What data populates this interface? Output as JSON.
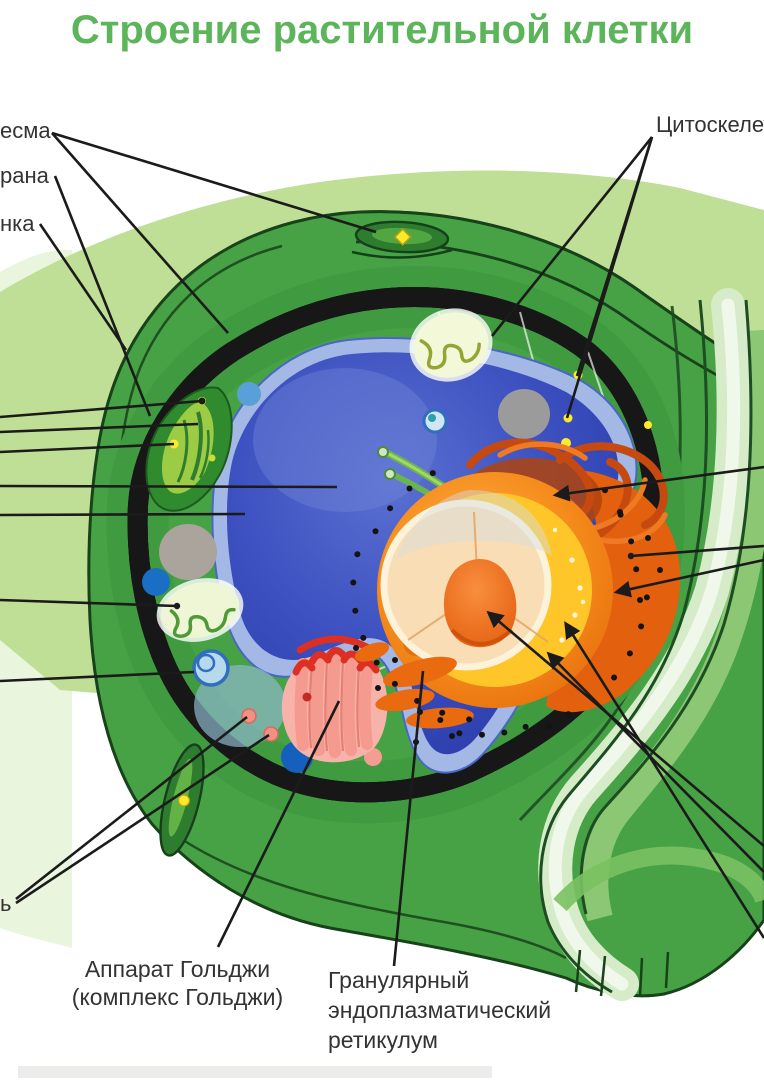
{
  "title": "Строение растительной клетки",
  "labels": {
    "plasmodesma_fragment": "есма",
    "membrane_fragment": "рана",
    "wall_fragment": "нка",
    "cytoskeleton": "Цитоскелет",
    "vacuole_fragment": "ь",
    "golgi_line1": "Аппарат Гольджи",
    "golgi_line2": "(комплекс Гольджи)",
    "er_line1": "Гранулярный",
    "er_line2": "эндоплазматический",
    "er_line3": "ретикулум"
  },
  "colors": {
    "title_green": "#5cb55a",
    "label_text": "#333333",
    "back_light_green": "#bedf95",
    "pale_left_band": "#e9f5dd",
    "wall_green": "#47a245",
    "wall_inner_green": "#3f9a40",
    "wall_dark_outline": "#17421a",
    "membrane_yellow": "#f9e426",
    "cytoplasm_blue": "#b7dbf1",
    "vacuole_blue": "#3a4fc0",
    "vacuole_halo": "#a3b8e4",
    "nucleus_orange": "#f08218",
    "nucleus_gold_ring": "#ffc62a",
    "nucleolus_orange": "#ea6316",
    "rough_er_orange": "#e2600e",
    "smooth_er_red": "#c64a10",
    "golgi_pink": "#f7aaa0",
    "golgi_red": "#dd2f24",
    "chloroplast_green": "#2f8b2e",
    "mitochondria_cream": "#f3f8d9",
    "leader_line": "#1b1b1b"
  },
  "structures": [
    "cell-wall",
    "plasma-membrane",
    "cytoplasm",
    "vacuole",
    "tonoplast",
    "nucleus",
    "nucleolus",
    "rough-er",
    "smooth-er",
    "golgi-apparatus",
    "chloroplast",
    "mitochondrion",
    "plasmodesma",
    "cytoskeleton-filaments",
    "ribosomes",
    "vesicles"
  ]
}
